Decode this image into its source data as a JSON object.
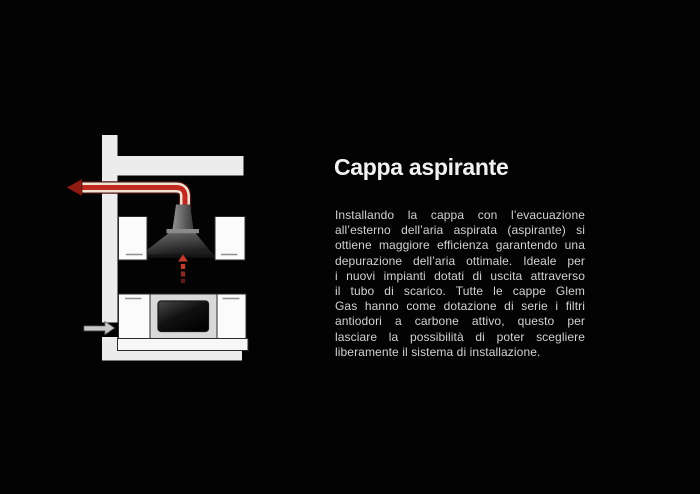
{
  "slide": {
    "title": "Cappa aspirante",
    "paragraph_lines": [
      "Installando la cappa con l’evacuazione",
      "all’esterno dell’aria aspirata (aspirante) si",
      "ottiene maggiore efficienza garantendo una",
      "depurazione dell’aria ottimale. Ideale per",
      "i nuovi impianti dotati di uscita attraverso",
      "il tubo di scarico. Tutte le cappe Glem",
      "Gas hanno come dotazione di serie i filtri",
      "antiodori a carbone attivo, questo per",
      "lasciare la possibilità di poter scegliere",
      "liberamente il sistema di installazione."
    ],
    "colors": {
      "background": "#030303",
      "title_text": "#f2f2f2",
      "body_text": "#d2d2d2",
      "wall": "#ececec",
      "cabinet_fill": "#fbfbfb",
      "cabinet_border": "#2b2b2b",
      "plinth_fill": "#f7f7f7",
      "oven_frame": "#d9d9d9",
      "handle_gray": "#909090",
      "duct_red": "#c1281e",
      "duct_casing": "#f0e2d2",
      "duct_edge": "#4a120c",
      "duct_arrowhead": "#8e1c13",
      "suction_red": "#c43a2d",
      "intake_arrow_fill": "#c9c9c9",
      "intake_arrow_border": "#6b6b6b",
      "hood_light": "#929292",
      "hood_mid": "#6a6a6a",
      "hood_dark": "#383838",
      "canopy_light": "#777777",
      "canopy_dark": "#1e1e1e",
      "junction_band": "#8a8a8a",
      "oven_glass_light": "#4a4a4a",
      "oven_glass_dark": "#000000"
    }
  }
}
